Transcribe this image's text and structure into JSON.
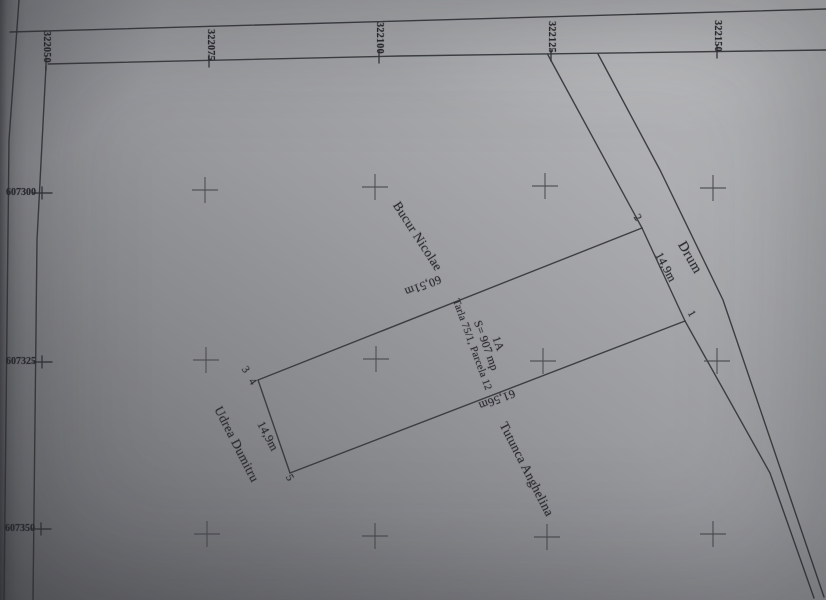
{
  "document_type": "cadastral parcel plan (scanned)",
  "parcel": {
    "id_label": "1A",
    "area_label": "S= 907 mp",
    "lot_label": "Tarla 75/1, Parcela 12",
    "point_numbers": [
      "1",
      "2",
      "3",
      "4",
      "5"
    ],
    "dimensions": [
      "14,9m",
      "60,51m",
      "14,9m",
      "61,56m"
    ]
  },
  "neighbors": [
    "Bucur Nicolae",
    "Drum",
    "Udrea Dumitru",
    "Tutunca Anghelina"
  ],
  "grid": {
    "easting_labels": [
      "322050",
      "322075",
      "322100",
      "322125",
      "322150"
    ],
    "northing_labels": [
      "607300",
      "607325",
      "607350"
    ]
  },
  "colors": {
    "ink": "#35363b",
    "paper_light": "#bcbdbf",
    "paper_dark": "#606165",
    "text": "#2b2b31"
  },
  "render": {
    "width": 826,
    "height": 600,
    "lines": [
      {
        "name": "outer-left-border",
        "pts": [
          [
            19,
            0
          ],
          [
            9,
            140
          ],
          [
            4,
            600
          ]
        ]
      },
      {
        "name": "outer-top-border",
        "pts": [
          [
            10,
            32
          ],
          [
            826,
            9
          ]
        ]
      },
      {
        "name": "inner-top-border",
        "pts": [
          [
            48,
            64
          ],
          [
            400,
            56
          ],
          [
            826,
            50
          ]
        ]
      },
      {
        "name": "inner-left-border",
        "pts": [
          [
            46,
            66
          ],
          [
            37,
            240
          ],
          [
            33,
            600
          ]
        ]
      },
      {
        "name": "grid-tick-322050",
        "pts": [
          [
            46,
            58
          ],
          [
            46,
            70
          ]
        ]
      },
      {
        "name": "grid-tick-322075",
        "pts": [
          [
            209,
            55
          ],
          [
            209,
            67
          ]
        ]
      },
      {
        "name": "grid-tick-322100",
        "pts": [
          [
            379,
            51
          ],
          [
            379,
            63
          ]
        ]
      },
      {
        "name": "grid-tick-322125",
        "pts": [
          [
            551,
            49
          ],
          [
            551,
            61
          ]
        ]
      },
      {
        "name": "grid-tick-322150",
        "pts": [
          [
            717,
            46
          ],
          [
            717,
            58
          ]
        ]
      },
      {
        "name": "grid-tick-607300-h",
        "pts": [
          [
            33,
            193
          ],
          [
            52,
            193
          ]
        ]
      },
      {
        "name": "grid-tick-607300-v",
        "pts": [
          [
            42,
            187
          ],
          [
            42,
            199
          ]
        ]
      },
      {
        "name": "grid-tick-607325-h",
        "pts": [
          [
            33,
            362
          ],
          [
            52,
            362
          ]
        ]
      },
      {
        "name": "grid-tick-607325-v",
        "pts": [
          [
            42,
            356
          ],
          [
            42,
            368
          ]
        ]
      },
      {
        "name": "grid-tick-607350-h",
        "pts": [
          [
            32,
            529
          ],
          [
            51,
            529
          ]
        ]
      },
      {
        "name": "grid-tick-607350-v",
        "pts": [
          [
            41,
            523
          ],
          [
            41,
            535
          ]
        ]
      },
      {
        "name": "road-left-edge-upper",
        "pts": [
          [
            548,
            55
          ],
          [
            642,
            228
          ]
        ]
      },
      {
        "name": "road-left-edge-lower",
        "pts": [
          [
            685,
            321
          ],
          [
            770,
            473
          ],
          [
            814,
            598
          ]
        ]
      },
      {
        "name": "road-right-edge",
        "pts": [
          [
            598,
            54
          ],
          [
            660,
            170
          ],
          [
            723,
            300
          ],
          [
            824,
            597
          ]
        ]
      },
      {
        "name": "parcel-edge-2-34",
        "pts": [
          [
            642,
            228
          ],
          [
            258,
            380
          ]
        ]
      },
      {
        "name": "parcel-edge-34-5",
        "pts": [
          [
            258,
            380
          ],
          [
            290,
            473
          ]
        ]
      },
      {
        "name": "parcel-edge-5-1",
        "pts": [
          [
            290,
            473
          ],
          [
            685,
            321
          ]
        ]
      },
      {
        "name": "parcel-edge-1-2",
        "pts": [
          [
            685,
            321
          ],
          [
            642,
            228
          ]
        ]
      }
    ],
    "crosses": {
      "arm": 13,
      "points": [
        [
          205,
          190
        ],
        [
          375,
          187
        ],
        [
          545,
          186
        ],
        [
          713,
          188
        ],
        [
          206,
          360
        ],
        [
          376,
          359
        ],
        [
          543,
          361
        ],
        [
          717,
          361
        ],
        [
          207,
          534
        ],
        [
          375,
          536
        ],
        [
          547,
          537
        ],
        [
          713,
          534
        ]
      ]
    },
    "labels": [
      {
        "name": "grid-label-322050",
        "text": "322050",
        "x": 46,
        "y": 47,
        "rot": 90,
        "size": 10,
        "weight": 700,
        "ls": 0.3
      },
      {
        "name": "grid-label-322075",
        "text": "322075",
        "x": 210,
        "y": 45,
        "rot": 90,
        "size": 10,
        "weight": 700,
        "ls": 0.3
      },
      {
        "name": "grid-label-322100",
        "text": "322100",
        "x": 379,
        "y": 38,
        "rot": 90,
        "size": 10,
        "weight": 700,
        "ls": 0.3
      },
      {
        "name": "grid-label-322125",
        "text": "322125",
        "x": 551,
        "y": 37,
        "rot": 90,
        "size": 10,
        "weight": 700,
        "ls": 0.3
      },
      {
        "name": "grid-label-322150",
        "text": "322150",
        "x": 717,
        "y": 36,
        "rot": 90,
        "size": 10,
        "weight": 700,
        "ls": 0.3
      },
      {
        "name": "grid-label-607300",
        "text": "607300",
        "x": 21,
        "y": 193,
        "rot": 0,
        "size": 10,
        "weight": 700,
        "ls": 0
      },
      {
        "name": "grid-label-607325",
        "text": "607325",
        "x": 21,
        "y": 362,
        "rot": 0,
        "size": 10,
        "weight": 700,
        "ls": 0
      },
      {
        "name": "grid-label-607350",
        "text": "607350",
        "x": 20,
        "y": 529,
        "rot": 0,
        "size": 10,
        "weight": 700,
        "ls": 0
      },
      {
        "name": "point-label-2",
        "text": "2",
        "x": 637,
        "y": 218,
        "rot": 55,
        "size": 11,
        "weight": 400,
        "ls": 0
      },
      {
        "name": "point-label-1",
        "text": "1",
        "x": 691,
        "y": 314,
        "rot": 60,
        "size": 11,
        "weight": 400,
        "ls": 0
      },
      {
        "name": "point-label-3",
        "text": "3",
        "x": 245,
        "y": 370,
        "rot": 55,
        "size": 11,
        "weight": 400,
        "ls": 0
      },
      {
        "name": "point-label-4",
        "text": "4",
        "x": 252,
        "y": 382,
        "rot": 55,
        "size": 11,
        "weight": 400,
        "ls": 0
      },
      {
        "name": "point-label-5",
        "text": "5",
        "x": 289,
        "y": 478,
        "rot": 60,
        "size": 11,
        "weight": 400,
        "ls": 0
      },
      {
        "name": "dim-front-14-9m",
        "text": "14,9m",
        "x": 666,
        "y": 267,
        "rot": 62,
        "size": 12,
        "weight": 400,
        "ls": 0.3
      },
      {
        "name": "dim-side-60-51m",
        "text": "60,51m",
        "x": 423,
        "y": 286,
        "rot": 159,
        "size": 12,
        "weight": 400,
        "ls": 0.3
      },
      {
        "name": "dim-back-14-9m",
        "text": "14,9m",
        "x": 268,
        "y": 436,
        "rot": 62,
        "size": 12,
        "weight": 400,
        "ls": 0.3
      },
      {
        "name": "dim-side-61-56m",
        "text": "61,56m",
        "x": 497,
        "y": 400,
        "rot": 159,
        "size": 12,
        "weight": 400,
        "ls": 0.3
      },
      {
        "name": "parcel-id",
        "text": "1A",
        "x": 497,
        "y": 344,
        "rot": 70,
        "size": 11.5,
        "weight": 400,
        "ls": 0.2
      },
      {
        "name": "parcel-area",
        "text": "S= 907 mp",
        "x": 485,
        "y": 346,
        "rot": 70,
        "size": 11.5,
        "weight": 400,
        "ls": 0.2
      },
      {
        "name": "parcel-lot",
        "text": "Tarla 75/1, Parcela 12",
        "x": 471,
        "y": 345,
        "rot": 70,
        "size": 10.5,
        "weight": 400,
        "ls": 0.2
      },
      {
        "name": "neighbor-bucur-nicolae",
        "text": "Bucur Nicolae",
        "x": 418,
        "y": 236,
        "rot": 57,
        "size": 13,
        "weight": 400,
        "ls": 0.3
      },
      {
        "name": "neighbor-drum",
        "text": "Drum",
        "x": 689,
        "y": 258,
        "rot": 60,
        "size": 14,
        "weight": 400,
        "ls": 0.5
      },
      {
        "name": "neighbor-udrea-dumitru",
        "text": "Udrea Dumitru",
        "x": 237,
        "y": 444,
        "rot": 63,
        "size": 13,
        "weight": 400,
        "ls": 0.3
      },
      {
        "name": "neighbor-tutunca-anghelina",
        "text": "Tutunca Anghelina",
        "x": 527,
        "y": 469,
        "rot": 63,
        "size": 13,
        "weight": 400,
        "ls": 0.3
      }
    ]
  }
}
